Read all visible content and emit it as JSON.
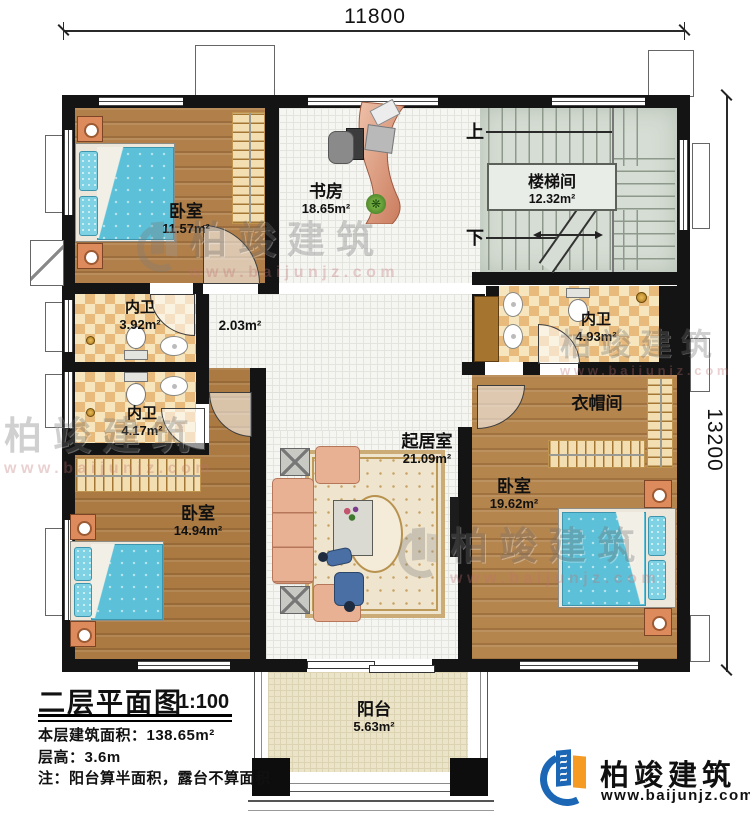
{
  "dimensions": {
    "width_label": "11800",
    "height_label": "13200"
  },
  "rooms": {
    "bedroom_tl": {
      "name": "卧室",
      "area": "11.57m²"
    },
    "study": {
      "name": "书房",
      "area": "18.65m²"
    },
    "stairwell": {
      "name": "楼梯间",
      "area": "12.32m²"
    },
    "bath1": {
      "name": "内卫",
      "area": "3.92m²"
    },
    "bath2": {
      "name": "内卫",
      "area": "4.17m²"
    },
    "bath3": {
      "name": "内卫",
      "area": "4.93m²"
    },
    "cloakroom": {
      "name": "衣帽间"
    },
    "hallway": {
      "area": "2.03m²"
    },
    "living": {
      "name": "起居室",
      "area": "21.09m²"
    },
    "bedroom_bl": {
      "name": "卧室",
      "area": "14.94m²"
    },
    "bedroom_br": {
      "name": "卧室",
      "area": "19.62m²"
    },
    "balcony": {
      "name": "阳台",
      "area": "5.63m²"
    }
  },
  "stairs": {
    "up_label": "上",
    "down_label": "下"
  },
  "title_block": {
    "title": "二层平面图",
    "scale": "1:100",
    "area_line": "本层建筑面积：138.65m²",
    "height_line": "层高：3.6m",
    "note_line": "注：阳台算半面积，露台不算面积"
  },
  "brand": {
    "name": "柏竣建筑",
    "website": "www.baijunjz.com"
  },
  "watermark": {
    "name": "柏竣建筑",
    "website": "www.baijunjz.com"
  },
  "colors": {
    "brand_blue": "#1c67b5",
    "brand_orange": "#f59a23",
    "wall": "#141414"
  }
}
